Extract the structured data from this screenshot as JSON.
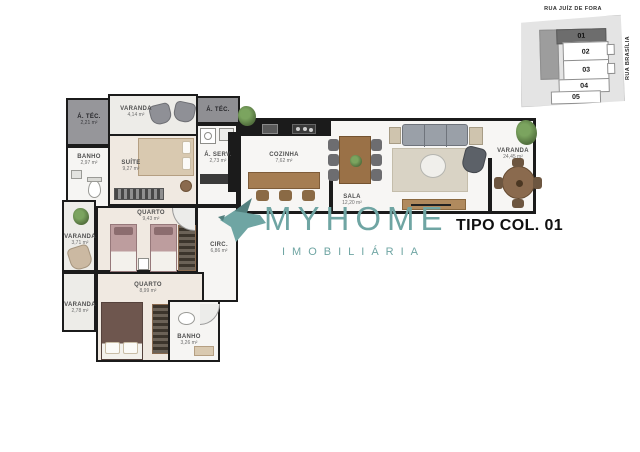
{
  "title": "TIPO COL. 01",
  "logo": {
    "brand": "MYHOME",
    "subtitle": "IMOBILIÁRIA"
  },
  "sitemap": {
    "street_top": "RUA JUÍZ DE FORA",
    "street_right": "RUA BRASÍLIA",
    "units": [
      "01",
      "02",
      "03",
      "04",
      "05"
    ],
    "highlighted_unit": "01"
  },
  "rooms": [
    {
      "id": "area-tecnica-1",
      "label": "Á. TÉC.",
      "area": "2,21 m²"
    },
    {
      "id": "varanda-suite",
      "label": "VARANDA",
      "area": "4,14 m²"
    },
    {
      "id": "area-tecnica-2",
      "label": "Á. TÉC.",
      "area": ""
    },
    {
      "id": "banho-suite",
      "label": "BANHO",
      "area": "2,97 m²"
    },
    {
      "id": "suite",
      "label": "SUÍTE",
      "area": "9,27 m²"
    },
    {
      "id": "area-servico",
      "label": "Á. SERV.",
      "area": "2,73 m²"
    },
    {
      "id": "quarto-1",
      "label": "QUARTO",
      "area": "9,43 m²"
    },
    {
      "id": "varanda-2",
      "label": "VARANDA",
      "area": "3,71 m²"
    },
    {
      "id": "circulacao",
      "label": "CIRC.",
      "area": "6,86 m²"
    },
    {
      "id": "quarto-2",
      "label": "QUARTO",
      "area": "8,99 m²"
    },
    {
      "id": "varanda-3",
      "label": "VARANDA",
      "area": "2,78 m²"
    },
    {
      "id": "banho-2",
      "label": "BANHO",
      "area": "3,26 m²"
    },
    {
      "id": "cozinha",
      "label": "COZINHA",
      "area": "7,62 m²"
    },
    {
      "id": "sala",
      "label": "SALA",
      "area": "12,20 m²"
    },
    {
      "id": "varanda-gourmet",
      "label": "VARANDA",
      "area": "24,45 m²"
    }
  ],
  "colors": {
    "brand_teal": "#6FA5A3",
    "wall_black": "#1B1B1B",
    "dark_area_gray": "#96969A",
    "bedroom_floor": "#F0E9E1",
    "wet_floor": "#F6F5F3",
    "wood": "#9A7147",
    "highlight_unit_gray": "#6D6D6D"
  }
}
